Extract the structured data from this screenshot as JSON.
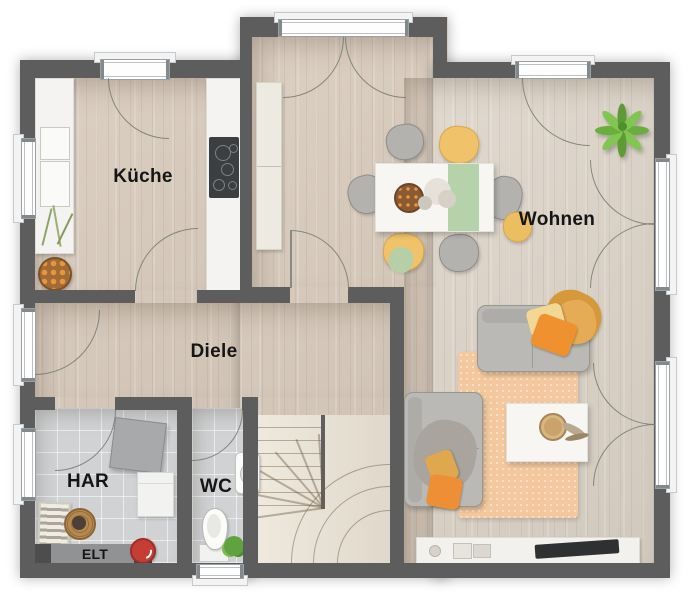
{
  "title": "Grundriss Erdgeschoss",
  "rooms": {
    "kueche": {
      "label": "Küche"
    },
    "wohnen": {
      "label": "Wohnen"
    },
    "diele": {
      "label": "Diele"
    },
    "har": {
      "label": "HAR"
    },
    "wc": {
      "label": "WC"
    },
    "elt": {
      "label": "ELT"
    }
  },
  "colors": {
    "wall": "#5d5d5d",
    "wood_floor": "#d7c9ba",
    "wood_floor_light": "#dcd3c7",
    "tile_floor": "#d0d2d4",
    "stair_wood": "#e9e1d3",
    "rug": "#f3c89e",
    "sofa_gray": "#bab9b6",
    "accent_orange": "#ef8f35",
    "accent_yellow": "#f0c26a",
    "table_runner_green": "#b5d2ab",
    "plant_green": "#6aae3d",
    "cooktop_dark": "#3c3f42",
    "vacuum_red": "#c63d34"
  }
}
